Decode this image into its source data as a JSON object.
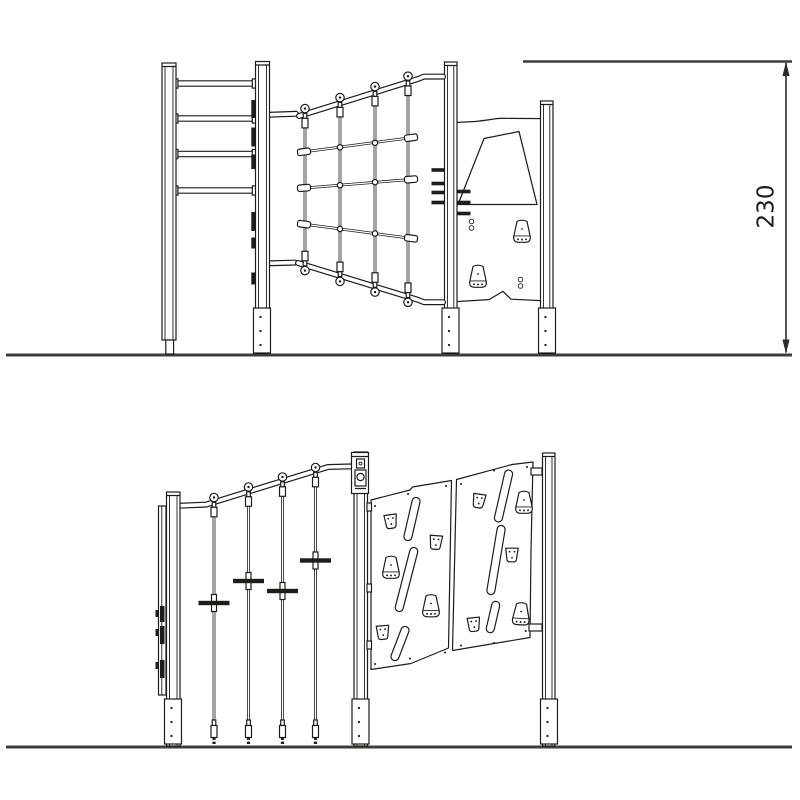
{
  "dimension": {
    "value": "230",
    "orientation": "vertical"
  },
  "colors": {
    "line": "#1d1d1b",
    "ground": "#3d3d3b",
    "dimension": "#2b2b29",
    "background": "#ffffff"
  },
  "drawing": {
    "type": "playground-structure-technical-drawing",
    "views": [
      {
        "id": "top",
        "name": "elevation-view-1",
        "components": [
          "horizontal-bar-ladder",
          "climbing-net",
          "climbing-panel-with-holds",
          "support-posts",
          "ground-line",
          "height-dimension"
        ]
      },
      {
        "id": "bottom",
        "name": "elevation-view-2",
        "components": [
          "panel-edge-profile",
          "vertical-climbing-ropes-with-grips",
          "rope-tensioner",
          "climbing-wall-panels-with-holds",
          "support-posts",
          "ground-line"
        ]
      }
    ],
    "counts": {
      "ladder_rungs": 4,
      "net_vertical_ropes": 4,
      "net_horizontal_ropes": 3,
      "panel_holds": 2,
      "foot_pegs": 7,
      "climb_ropes": 4,
      "rope_grips": 4,
      "wall_panels": 2,
      "wall_slots": 6,
      "wall_holds": 10
    }
  }
}
